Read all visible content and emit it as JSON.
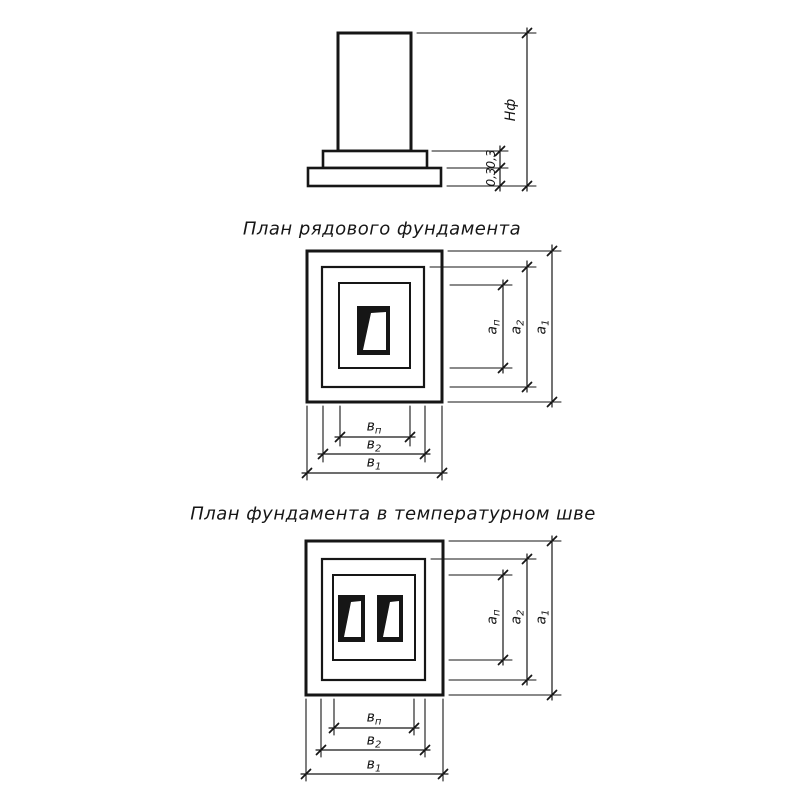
{
  "colors": {
    "ink": "#161616",
    "paper": "#ffffff"
  },
  "elevation": {
    "dim_total_height": "Нф",
    "dim_step_upper": "0,3",
    "dim_step_lower": "0,3"
  },
  "plan1": {
    "title": "План рядового фундамента",
    "dims": {
      "a_inner": {
        "base": "а",
        "sub": "п"
      },
      "a_mid": {
        "base": "а",
        "sub": "2"
      },
      "a_outer": {
        "base": "а",
        "sub": "1"
      },
      "b_inner": {
        "base": "в",
        "sub": "п"
      },
      "b_mid": {
        "base": "в",
        "sub": "2"
      },
      "b_outer": {
        "base": "в",
        "sub": "1"
      }
    }
  },
  "plan2": {
    "title": "План фундамента в температурном шве",
    "dims": {
      "a_inner": {
        "base": "а",
        "sub": "п"
      },
      "a_mid": {
        "base": "а",
        "sub": "2"
      },
      "a_outer": {
        "base": "а",
        "sub": "1"
      },
      "b_inner": {
        "base": "в",
        "sub": "п"
      },
      "b_mid": {
        "base": "в",
        "sub": "2"
      },
      "b_outer": {
        "base": "в",
        "sub": "1"
      }
    }
  }
}
